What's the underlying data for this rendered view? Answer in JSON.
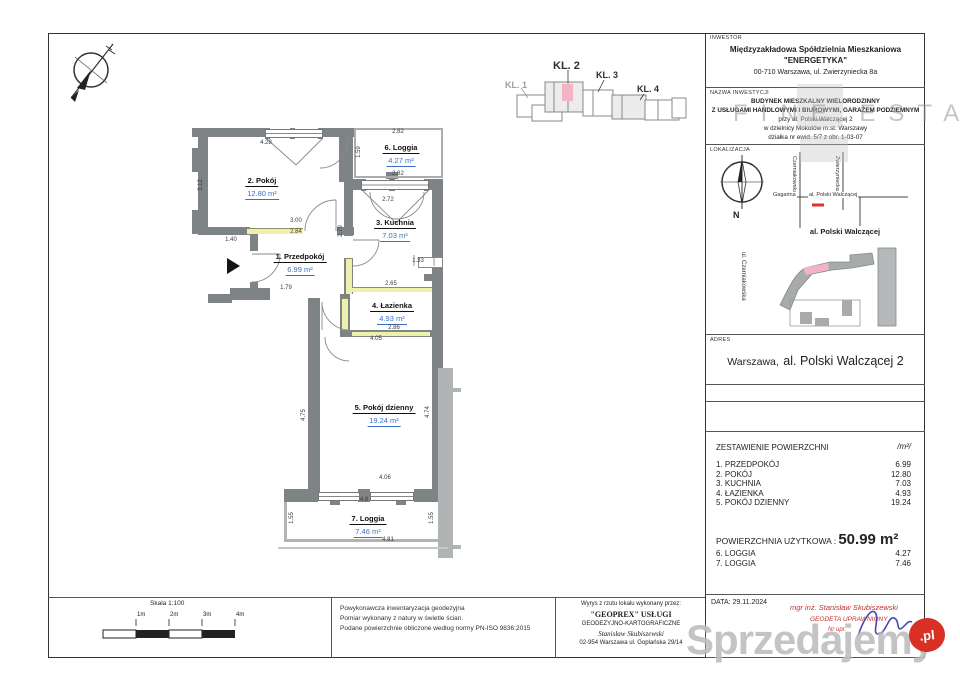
{
  "watermarks": {
    "estate": "FINE ESTATE",
    "portal": "Sprzedajemy",
    "portal_badge": ".pl"
  },
  "compass_n": "N",
  "key_plan": {
    "kl1": "KL. 1",
    "kl2": "KL. 2",
    "kl3": "KL. 3",
    "kl4": "KL. 4"
  },
  "plan": {
    "rooms": [
      {
        "name": "2. Pokój",
        "area": "12.80 m²"
      },
      {
        "name": "6. Loggia",
        "area": "4.27 m²"
      },
      {
        "name": "3. Kuchnia",
        "area": "7.03 m²"
      },
      {
        "name": "1. Przedpokój",
        "area": "6.99 m²"
      },
      {
        "name": "4. Łazienka",
        "area": "4.93 m²"
      },
      {
        "name": "5. Pokój dzienny",
        "area": "19.24 m²"
      },
      {
        "name": "7. Loggia",
        "area": "7.46 m²"
      }
    ],
    "dimensions": [
      {
        "t": "4.28",
        "x": 266,
        "y": 143,
        "r": 0
      },
      {
        "t": "3.12",
        "x": 201,
        "y": 185,
        "r": 1
      },
      {
        "t": "1.40",
        "x": 231,
        "y": 240,
        "r": 0
      },
      {
        "t": "3.00",
        "x": 296,
        "y": 221,
        "r": 0
      },
      {
        "t": "2.84",
        "x": 296,
        "y": 232,
        "r": 0
      },
      {
        "t": "1.79",
        "x": 286,
        "y": 288,
        "r": 0
      },
      {
        "t": "2.82",
        "x": 398,
        "y": 132,
        "r": 0
      },
      {
        "t": "1.59",
        "x": 359,
        "y": 152,
        "r": 1
      },
      {
        "t": "2.82",
        "x": 398,
        "y": 174,
        "r": 0
      },
      {
        "t": "2.72",
        "x": 388,
        "y": 200,
        "r": 0
      },
      {
        "t": "2.79",
        "x": 341,
        "y": 231,
        "r": 1
      },
      {
        "t": "1.33",
        "x": 418,
        "y": 261,
        "r": 0
      },
      {
        "t": "2.65",
        "x": 391,
        "y": 284,
        "r": 0
      },
      {
        "t": "2.86",
        "x": 394,
        "y": 328,
        "r": 0
      },
      {
        "t": "4.05",
        "x": 376,
        "y": 339,
        "r": 0
      },
      {
        "t": "4.75",
        "x": 304,
        "y": 415,
        "r": 1
      },
      {
        "t": "4.74",
        "x": 428,
        "y": 412,
        "r": 1
      },
      {
        "t": "4.06",
        "x": 385,
        "y": 478,
        "r": 0
      },
      {
        "t": "4.8",
        "x": 364,
        "y": 500,
        "r": 0
      },
      {
        "t": "1.55",
        "x": 292,
        "y": 518,
        "r": 1
      },
      {
        "t": "1.55",
        "x": 432,
        "y": 518,
        "r": 1
      },
      {
        "t": "4.81",
        "x": 388,
        "y": 540,
        "r": 0
      }
    ]
  },
  "title_block": {
    "inwestor": {
      "label": "INWESTOR",
      "line1": "Międzyzakładowa Spółdzielnia Mieszkaniowa",
      "line2": "\"ENERGETYKA\"",
      "line3": "00-710 Warszawa, ul. Zwierzyniecka 8a"
    },
    "nazwa": {
      "label": "NAZWA INWESTYCJI",
      "line1": "BUDYNEK MIESZKALNY WIELORODZINNY",
      "line2": "Z USŁUGAMI HANDLOWYMI I BIUROWYMI, GARAŻEM PODZIEMNYM",
      "line3": "przy al. Polski Walczącej 2",
      "line4": "w dzielnicy Mokotów m.st. Warszawy",
      "line5": "działka nr ewid. 5/7 z obr. 1-03-07"
    },
    "lokalizacja": {
      "label": "LOKALIZACJA",
      "street_v1": "Czerniakowska",
      "street_v2": "Zwierzyniecka",
      "street_h_left": "Gagarina",
      "street_h": "al. Polski Walczącej",
      "caption": "al. Polski Walczącej",
      "site_street": "ul. Czerniakowska"
    },
    "adres": {
      "label": "ADRES",
      "city": "Warszawa,",
      "street": "al. Polski Walczącej 2"
    },
    "area_table": {
      "title": "ZESTAWIENIE POWIERZCHNI",
      "unit": "/m²/",
      "rows": [
        {
          "name": "1. PRZEDPOKÓJ",
          "value": "6.99"
        },
        {
          "name": "2. POKÓJ",
          "value": "12.80"
        },
        {
          "name": "3. KUCHNIA",
          "value": "7.03"
        },
        {
          "name": "4. ŁAZIENKA",
          "value": "4.93"
        },
        {
          "name": "5. POKÓJ DZIENNY",
          "value": "19.24"
        }
      ],
      "total_label": "POWIERZCHNIA UŻYTKOWA :",
      "total_value": "50.99 m²",
      "loggia_rows": [
        {
          "name": "6. LOGGIA",
          "value": "4.27"
        },
        {
          "name": "7. LOGGIA",
          "value": "7.46"
        }
      ]
    },
    "data_row": {
      "date": "DATA: 29.11.2024",
      "stamp1": "mgr inż. Stanisław Skubiszewski",
      "stamp2": "GEODETA UPRAWNIONY",
      "stamp3": "Nr upr."
    }
  },
  "footer": {
    "scale": {
      "title": "Skala 1:100",
      "ticks": [
        "1m",
        "2m",
        "3m",
        "4m"
      ]
    },
    "notes": [
      "Powykonawcza inwentaryzacja geodezyjna",
      "Pomiar wykonany z natury w świetle ścian.",
      "Podane powierzchnie obliczone według normy PN-ISO 9836:2015"
    ],
    "surveyor": {
      "line1": "Wyrys z rzutu lokalu wykonany przez:",
      "line2": "\"GEOPREX\" USŁUGI",
      "line3": "GEODEZYJNO-KARTOGRAFICZNE",
      "line4": "Stanisław Skubiszewski",
      "line5": "02-954 Warszawa ul. Goplańska 29/14"
    }
  },
  "colors": {
    "wall": "#7e8486",
    "wall_light": "#b0b4b5",
    "highlight": "#eef0ae",
    "area_text": "#3a6fc4",
    "stamp_red": "#c53030",
    "signature_blue": "#4949b0",
    "marker_pink": "#f2b3c4",
    "marker_red": "#e03030"
  }
}
